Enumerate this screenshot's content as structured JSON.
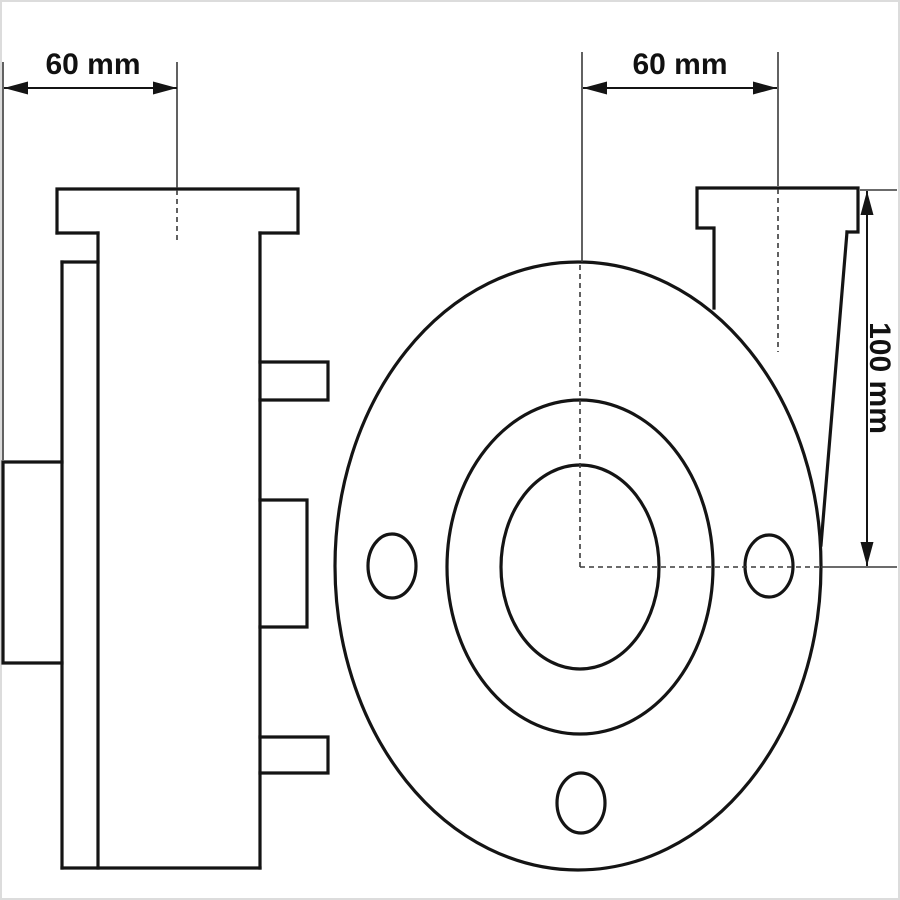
{
  "drawing": {
    "background": "#ffffff",
    "line_color": "#141414",
    "thin_line_color": "#3a3a3a",
    "text_color": "#111111",
    "labels": {
      "side_width": "60 mm",
      "discharge_offset": "60 mm",
      "casing_height": "100 mm"
    }
  }
}
